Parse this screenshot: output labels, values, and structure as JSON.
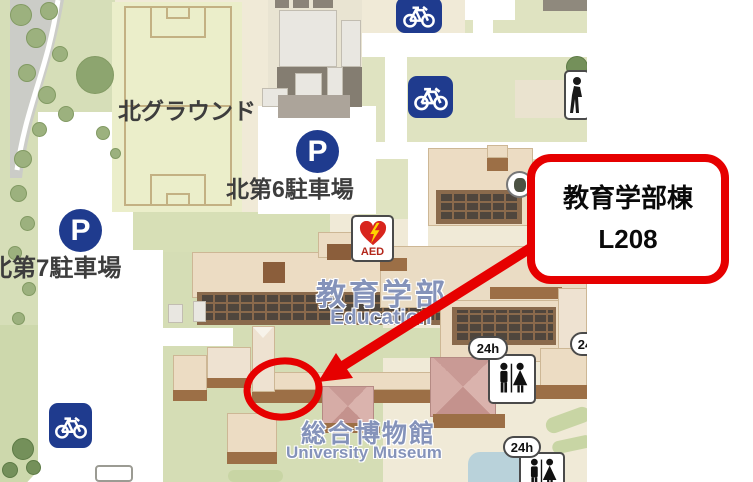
{
  "map": {
    "labels": {
      "north_ground": "北グラウンド",
      "parking6": "北第6駐車場",
      "parking7": "北第7駐車場",
      "education_ja": "教育学部",
      "education_en": "Education",
      "museum_ja": "総合博物館",
      "museum_en": "University Museum"
    },
    "icons": {
      "parking": "P",
      "aed": "AED",
      "hours": "24h"
    },
    "colors": {
      "annotation_red": "#e60000",
      "icon_navy": "#1f3b8e",
      "building_tan": "#ecdcc3",
      "shadow_brown": "#9c6f46",
      "blue_label": "#8593ba"
    }
  },
  "annotation": {
    "building_name": "教育学部棟",
    "room": "L208"
  }
}
